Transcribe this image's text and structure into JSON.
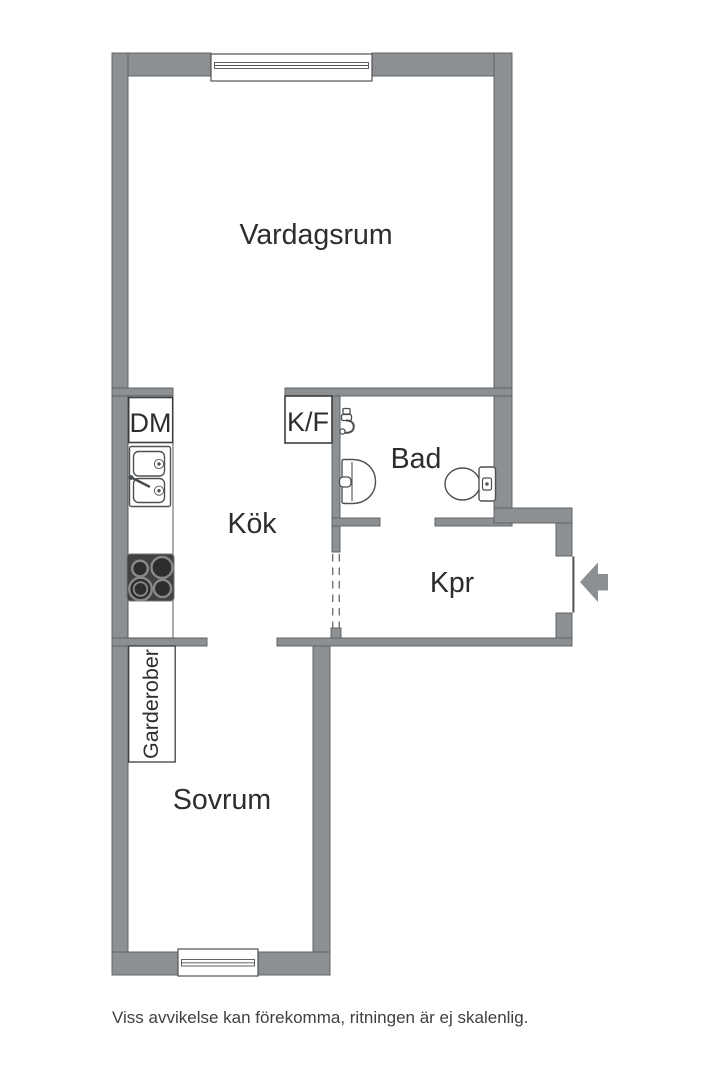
{
  "rooms": {
    "living_room": {
      "label": "Vardagsrum"
    },
    "kitchen": {
      "label": "Kök"
    },
    "bathroom": {
      "label": "Bad"
    },
    "hall": {
      "label": "Kpr"
    },
    "bedroom": {
      "label": "Sovrum"
    }
  },
  "fixtures": {
    "dishwasher": {
      "label": "DM"
    },
    "fridge_freezer": {
      "label": "K/F"
    },
    "wardrobes": {
      "label": "Garderober"
    }
  },
  "footer": {
    "disclaimer": "Viss avvikelse kan förekomma, ritningen är ej skalenlig."
  },
  "colors": {
    "wall_fill": "#8d9093",
    "wall_outline": "#606468",
    "line": "#4f5254",
    "text": "#2d2d2d",
    "caption": "#3f4042",
    "stove_body": "#3f4143",
    "dash": "#6f7376"
  }
}
